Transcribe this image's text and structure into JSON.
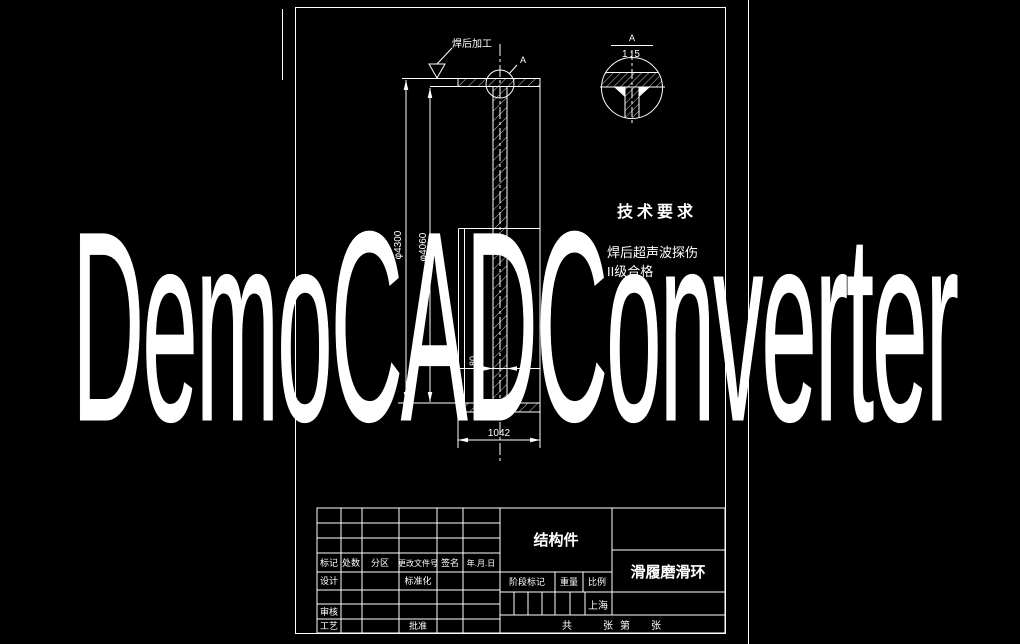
{
  "canvas": {
    "bg": "#000000",
    "line": "#ffffff"
  },
  "watermark": {
    "text": "DemoCADConverter"
  },
  "main_view": {
    "weld_note": "焊后加工",
    "detail_ref": "A"
  },
  "detail_view": {
    "label": "A",
    "scale": "1:5"
  },
  "tech_req": {
    "title": "技术要求",
    "line1": "焊后超声波探伤",
    "line2": "II级合格"
  },
  "dims": {
    "outer": "φ4300",
    "inner": "φ4060",
    "width": "1042",
    "web": "80"
  },
  "tb": {
    "mark": "标记",
    "count": "处数",
    "zone": "分区",
    "change": "更改文件号",
    "sign": "签名",
    "date": "年.月.日",
    "design": "设计",
    "standard": "标准化",
    "review": "审核",
    "process": "工艺",
    "approve": "批准",
    "stage": "阶段标记",
    "weight": "重量",
    "scale": "比例",
    "scale_value": "上海",
    "part_type": "结构件",
    "title": "滑履磨滑环",
    "total": "共",
    "sheet": "张",
    "no": "第",
    "sheet2": "张"
  }
}
